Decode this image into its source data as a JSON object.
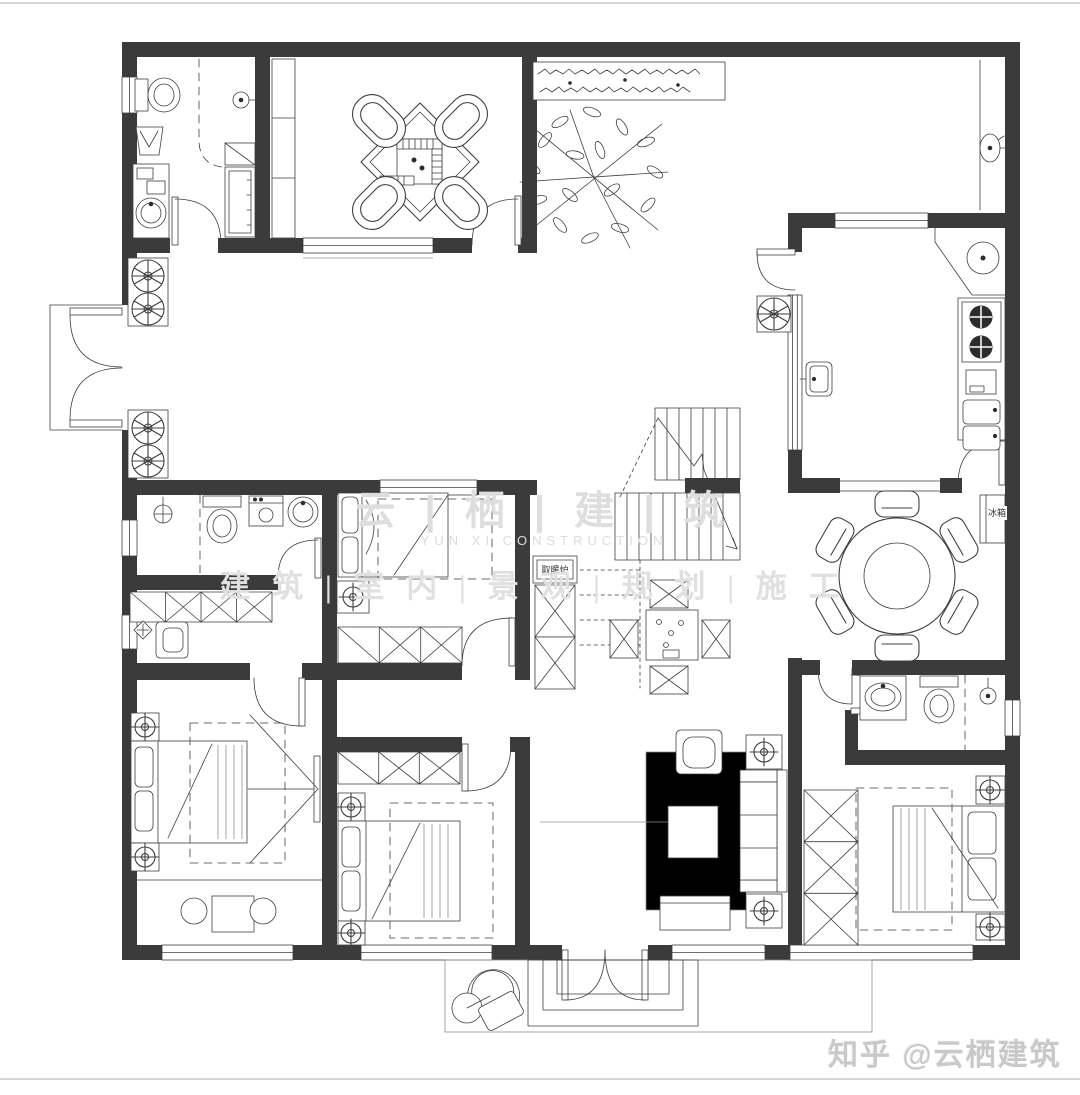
{
  "canvas": {
    "width": 1080,
    "height": 1095,
    "background": "#ffffff"
  },
  "colors": {
    "wall": "#3b3b3b",
    "line": "#3f3f3f",
    "light_line": "#8f8f8f",
    "watermark": "#dedede",
    "credit_text": "#c9c9c9"
  },
  "watermark": {
    "cn": "云 | 栖 | 建 | 筑",
    "en": "YUN XI CONSTRUCTION",
    "services": "建 筑 | 室 内 | 景 观 | 规 划 | 施 工"
  },
  "credit": {
    "text": "知乎 @云栖建筑"
  },
  "labels": {
    "heater": "取暖炉",
    "fridge": "冰箱"
  }
}
